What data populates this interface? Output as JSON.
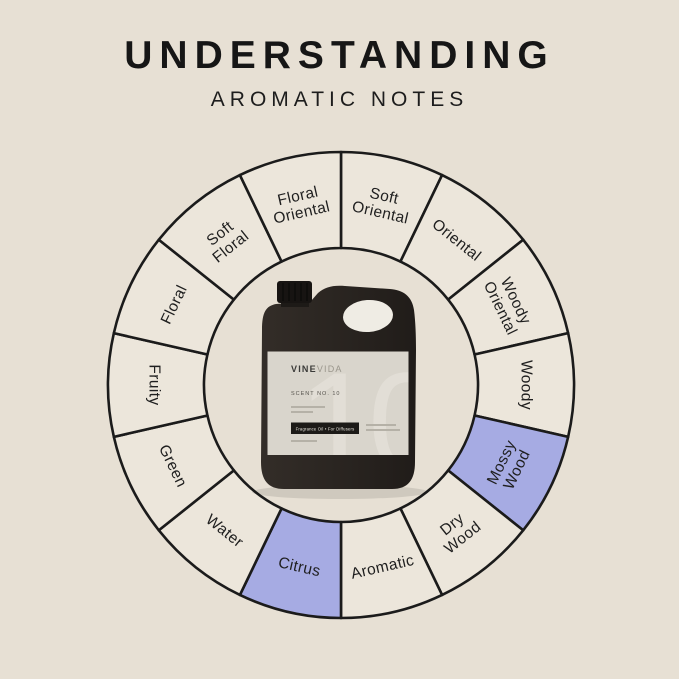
{
  "header": {
    "title": "UNDERSTANDING",
    "subtitle": "AROMATIC NOTES"
  },
  "colors": {
    "background": "#e7e0d4",
    "segment_fill": "#ece6db",
    "highlight_fill": "#a6abe3",
    "stroke": "#1b1b1b",
    "label_text": "#1f1f1f"
  },
  "wheel": {
    "description": "Fragrance wheel of 14 aromatic note families, clockwise from 12 o'clock; highlighted segments indicate this scent's notes",
    "segments": [
      {
        "label": "Soft Oriental",
        "lines": [
          "Soft",
          "Oriental"
        ],
        "highlighted": false
      },
      {
        "label": "Oriental",
        "lines": [
          "Oriental"
        ],
        "highlighted": false
      },
      {
        "label": "Woody Oriental",
        "lines": [
          "Woody",
          "Oriental"
        ],
        "highlighted": false
      },
      {
        "label": "Woody",
        "lines": [
          "Woody"
        ],
        "highlighted": false
      },
      {
        "label": "Mossy Wood",
        "lines": [
          "Mossy",
          "Wood"
        ],
        "highlighted": true
      },
      {
        "label": "Dry Wood",
        "lines": [
          "Dry",
          "Wood"
        ],
        "highlighted": false
      },
      {
        "label": "Aromatic",
        "lines": [
          "Aromatic"
        ],
        "highlighted": false
      },
      {
        "label": "Citrus",
        "lines": [
          "Citrus"
        ],
        "highlighted": true
      },
      {
        "label": "Water",
        "lines": [
          "Water"
        ],
        "highlighted": false
      },
      {
        "label": "Green",
        "lines": [
          "Green"
        ],
        "highlighted": false
      },
      {
        "label": "Fruity",
        "lines": [
          "Fruity"
        ],
        "highlighted": false
      },
      {
        "label": "Floral",
        "lines": [
          "Floral"
        ],
        "highlighted": false
      },
      {
        "label": "Soft Floral",
        "lines": [
          "Soft",
          "Floral"
        ],
        "highlighted": false
      },
      {
        "label": "Floral Oriental",
        "lines": [
          "Floral",
          "Oriental"
        ],
        "highlighted": false
      }
    ]
  },
  "bottle": {
    "brand_bold": "VINE",
    "brand_light": "VIDA",
    "scent_line": "SCENT NO. 10",
    "badge": "Fragrance Oil • For Diffusers",
    "watermark": "10"
  }
}
